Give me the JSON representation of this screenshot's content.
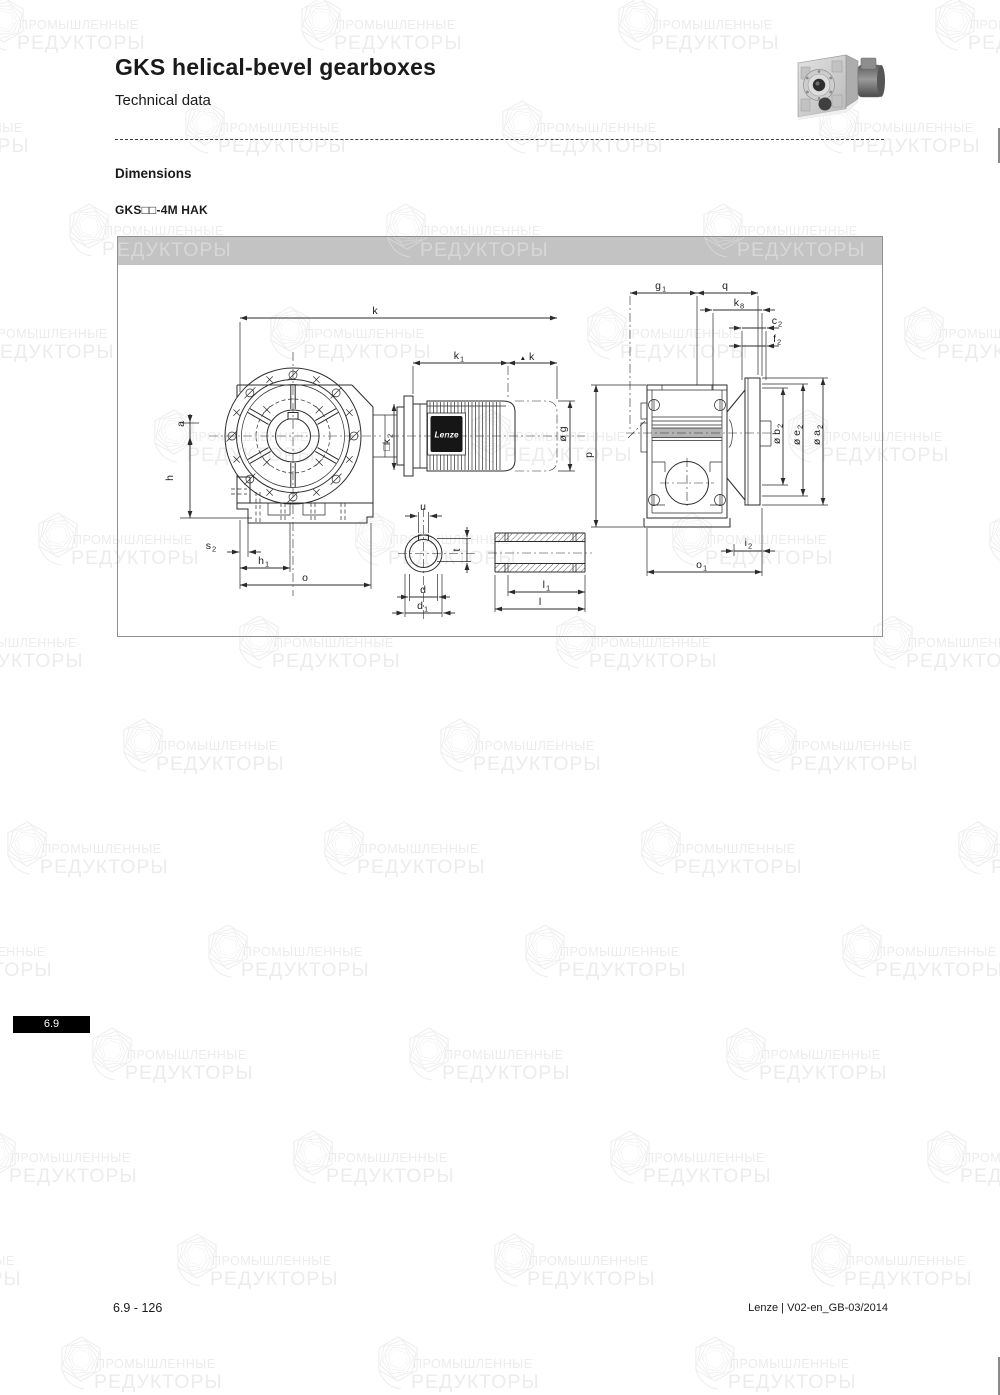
{
  "page": {
    "title": "GKS helical-bevel gearboxes",
    "subtitle": "Technical data",
    "section_heading": "Dimensions",
    "model_label": "GKS□□-4M HAK",
    "tab_label": "6.9",
    "footer_left": "6.9 - 126",
    "footer_right": "Lenze | V02-en_GB-03/2014"
  },
  "watermark": {
    "line1": "ПРОМЫШЛЕННЫЕ",
    "line2": "РЕДУКТОРЫ"
  },
  "colors": {
    "bar": "#c3c3c3",
    "tab_bg": "#000000",
    "watermark_global": "#ececec",
    "watermark_on_bar": "#d7d7d7",
    "drawing_line": "#2b2b2b"
  },
  "drawing": {
    "motor_brand": "Lenze",
    "labels": {
      "k": {
        "main": "k"
      },
      "k1": {
        "main": "k",
        "sub": "1"
      },
      "dk": {
        "tri": "▲",
        "main": "k"
      },
      "a": {
        "main": "a"
      },
      "h": {
        "main": "h"
      },
      "k2": {
        "main": "□k",
        "sub": "2"
      },
      "s2": {
        "main": "s",
        "sub": "2"
      },
      "h1": {
        "main": "h",
        "sub": "1"
      },
      "o": {
        "main": "o"
      },
      "u": {
        "main": "u"
      },
      "t": {
        "main": "t"
      },
      "d": {
        "main": "d"
      },
      "d1": {
        "main": "d",
        "sub": "1"
      },
      "l1": {
        "main": "l",
        "sub": "1"
      },
      "l": {
        "main": "l"
      },
      "g1": {
        "main": "g",
        "sub": "1"
      },
      "q": {
        "main": "q"
      },
      "k8": {
        "main": "k",
        "sub": "8"
      },
      "c2": {
        "main": "c",
        "sub": "2"
      },
      "f2": {
        "main": "f",
        "sub": "2"
      },
      "p": {
        "main": "p"
      },
      "og": {
        "main": "ø g"
      },
      "ob2": {
        "main": "ø b",
        "sub": "2"
      },
      "oe2": {
        "main": "ø e",
        "sub": "2"
      },
      "oa2": {
        "main": "ø a",
        "sub": "2"
      },
      "i2": {
        "main": "i",
        "sub": "2"
      },
      "o1": {
        "main": "o",
        "sub": "1"
      }
    }
  }
}
